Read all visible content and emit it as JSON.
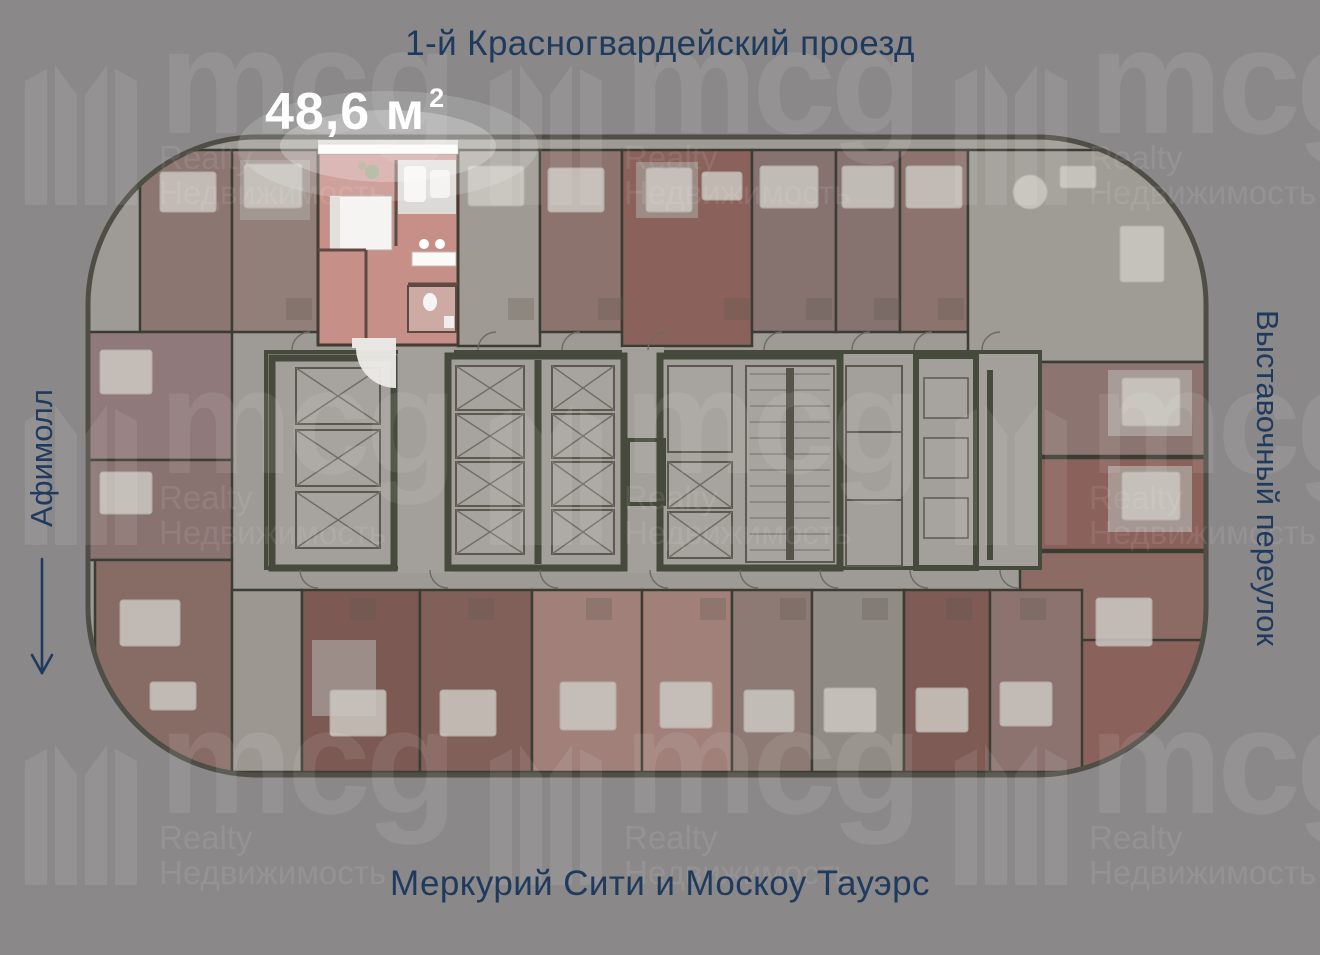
{
  "page": {
    "width": 1320,
    "height": 955,
    "background_color": "#8a8888"
  },
  "labels": {
    "street_top": "1-й Красногвардейский проезд",
    "street_right": "Выставочный переулок",
    "mall_left": "Афимолл",
    "towers_bottom": "Меркурий Сити и Москоу Тауэрс"
  },
  "highlighted_unit": {
    "area_main": "48,6 м",
    "area_superscript": "2",
    "area_full": "48,6 м²",
    "fill_color": "#c69089"
  },
  "watermark": {
    "brand": "mcg",
    "realty": "Realty",
    "nedvizhimost": "Недвижимость"
  },
  "colors": {
    "label_navy": "#1e3a5e",
    "area_label_white": "#ffffff",
    "plan_floor": "#9e9a95",
    "plan_wall_dark": "#454a3c",
    "unit_red_dark": "#7c5953",
    "unit_mauve": "#8d736e",
    "unit_gray": "#9f9b95"
  }
}
